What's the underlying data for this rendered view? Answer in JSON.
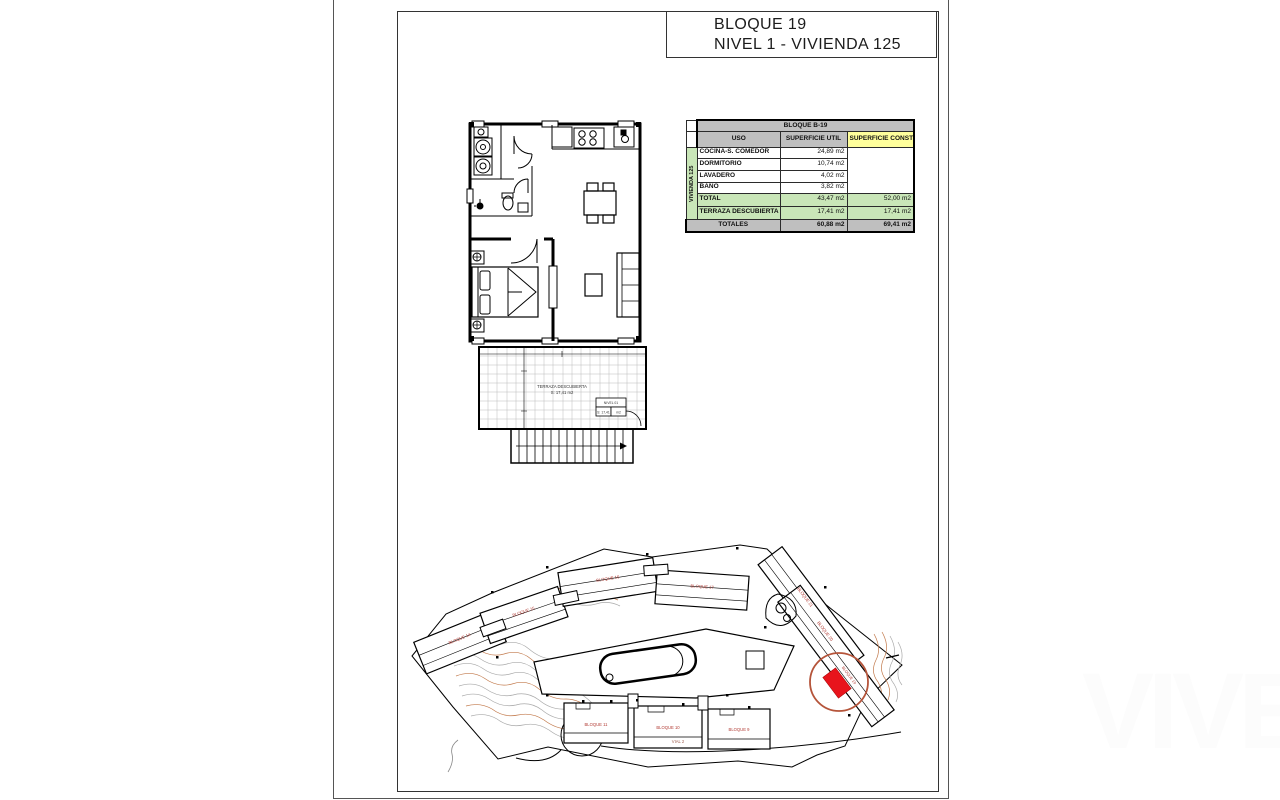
{
  "title": {
    "line1": "BLOQUE 19",
    "line2": "NIVEL 1 - VIVIENDA 125"
  },
  "area_table": {
    "block_header": "BLOQUE B-19",
    "unit_label": "VIVIENDA 125",
    "col_uso": "USO",
    "col_util": "SUPERFICIE UTIL",
    "col_construida": "SUPERFICIE CONSTRUIDA",
    "rows": [
      {
        "uso": "COCINA-S. COMEDOR",
        "util": "24,89 m2"
      },
      {
        "uso": "DORMITORIO",
        "util": "10,74 m2"
      },
      {
        "uso": "LAVADERO",
        "util": "4,02 m2"
      },
      {
        "uso": "BAÑO",
        "util": "3,82 m2"
      },
      {
        "uso": "TOTAL",
        "util": "43,47 m2",
        "construida": "52,00 m2"
      },
      {
        "uso": "TERRAZA DESCUBIERTA",
        "util": "17,41 m2",
        "construida": "17,41 m2"
      }
    ],
    "totales": {
      "label": "TOTALES",
      "util": "60,88 m2",
      "construida": "69,41 m2"
    }
  },
  "floor_plan": {
    "terrace_label": "TERRAZA DESCUBIERTA",
    "terrace_area": "S: 17,41 m2",
    "level_box": {
      "title": "NIVEL 01",
      "cell_a": "S: 17,41",
      "cell_b": "m2"
    }
  },
  "site_plan": {
    "labels": [
      "BLOQUE 14",
      "BLOQUE 15",
      "BLOQUE 16",
      "BLOQUE 17",
      "BLOQUE 21",
      "BLOQUE 20",
      "BLOQUE 19",
      "BLOQUE 11",
      "BLOQUE 10",
      "BLOQUE 9"
    ],
    "road_label": "VIAL 2",
    "highlight_color": "#e8141c",
    "circle_color": "#b5543a",
    "contour_gray": "#a9a9a9",
    "contour_orange": "#c27a4c",
    "label_color": "#b23b34"
  },
  "watermark": "VIVE"
}
